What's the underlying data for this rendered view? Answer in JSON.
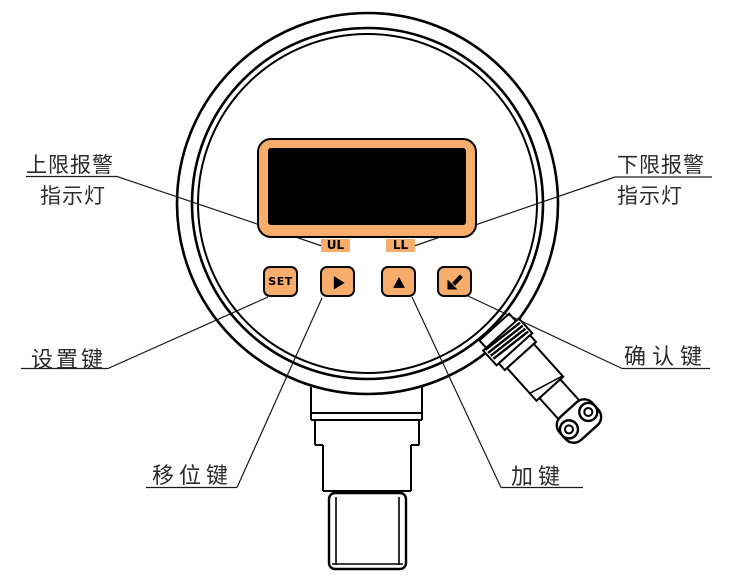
{
  "colors": {
    "accent": "#F6AC6A",
    "screen": "#000000",
    "line": "#000000",
    "text": "#2B2B2B"
  },
  "display": {
    "upper_lamp": "UL",
    "lower_lamp": "LL"
  },
  "keys": {
    "set_label": "SET",
    "shift_symbol": "right-triangle",
    "up_symbol": "up-triangle",
    "enter_symbol": "southwest-arrow"
  },
  "labels": {
    "upper_alarm": {
      "line1": "上限报警",
      "line2": "指示灯"
    },
    "lower_alarm": {
      "line1": "下限报警",
      "line2": "指示灯"
    },
    "set_key": "设置键",
    "confirm_key": "确认键",
    "shift_key": "移位键",
    "add_key": "加键"
  }
}
